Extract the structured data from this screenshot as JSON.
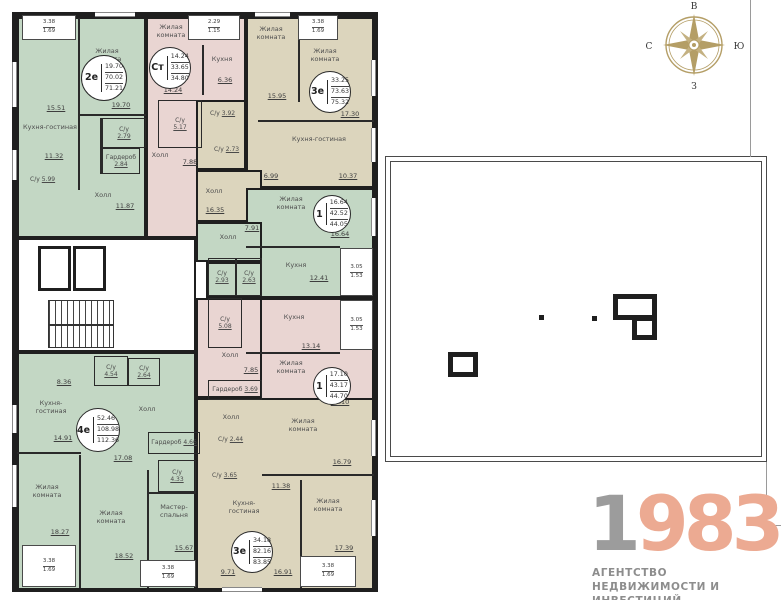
{
  "colors": {
    "green": "#c3d7c4",
    "pink": "#e9d5d2",
    "beige": "#dcd5bd",
    "wall": "#1f1f1f",
    "compass_gold": "#b49e66",
    "logo_gray": "#9c9c9c",
    "logo_accent": "#ecaa92",
    "logo_text": "#8d8d8d"
  },
  "compass": {
    "top": "В",
    "right": "Ю",
    "bottom": "З",
    "left": "С"
  },
  "logo": {
    "digit1": "1",
    "digits2": "983",
    "line1": "АГЕНТСТВО",
    "line2": "НЕДВИЖИМОСТИ И ИНВЕСТИЦИЙ"
  },
  "apartments": {
    "a2e": {
      "type": "2е",
      "stats": [
        "19.70",
        "70.02",
        "71.21"
      ],
      "rooms": {
        "living": {
          "name": "Жилая комната",
          "area": "19.70"
        },
        "kitchen": {
          "name": "Кухня-гостиная",
          "area1": "15.51",
          "area2": "11.32"
        },
        "su1": {
          "name": "С/у",
          "area": "2.79"
        },
        "wardrobe": {
          "name": "Гардероб",
          "area": "2.84"
        },
        "su2": {
          "name": "С/у",
          "area": "5.99"
        },
        "hall": {
          "name": "Холл",
          "area": "11.87"
        }
      },
      "balcony": {
        "a": "3.38",
        "b": "1.69"
      }
    },
    "ast": {
      "type": "Ст",
      "stats": [
        "14.24",
        "33.65",
        "34.80"
      ],
      "rooms": {
        "living": {
          "name": "Жилая комната",
          "area": "14.24"
        },
        "kitchen": {
          "name": "Кухня",
          "area": "6.36"
        },
        "su": {
          "name": "С/у",
          "area": "5.17"
        },
        "hall": {
          "name": "Холл",
          "area": "7.88"
        }
      },
      "balcony": {
        "a": "2.29",
        "b": "1.15"
      }
    },
    "a3e": {
      "type": "3е",
      "stats": [
        "33.25",
        "73.63",
        "75.32"
      ],
      "rooms": {
        "living1": {
          "name": "Жилая комната",
          "area": "15.95"
        },
        "living2": {
          "name": "Жилая комната",
          "area": "17.30"
        },
        "kitchen": {
          "name": "Кухня-гостиная",
          "area1": "6.99",
          "area2": "10.37"
        },
        "su1": {
          "name": "С/у",
          "area": "3.92"
        },
        "su2": {
          "name": "С/у",
          "area": "2.73"
        },
        "hall": {
          "name": "Холл",
          "area": "16.35"
        }
      },
      "balcony": {
        "a": "3.38",
        "b": "1.69"
      }
    },
    "a1g": {
      "type": "1",
      "stats": [
        "16.64",
        "42.52",
        "44.05"
      ],
      "rooms": {
        "living": {
          "name": "Жилая комната",
          "area": "16.64"
        },
        "kitchen": {
          "name": "Кухня",
          "area": "12.41"
        },
        "su1": {
          "name": "С/у",
          "area": "2.93"
        },
        "su2": {
          "name": "С/у",
          "area": "2.63"
        },
        "hall": {
          "name": "Холл",
          "area": "7.91"
        }
      },
      "balcony": {
        "a": "3.05",
        "b": "1.53"
      }
    },
    "a1p": {
      "type": "1",
      "stats": [
        "17.10",
        "43.17",
        "44.70"
      ],
      "rooms": {
        "living": {
          "name": "Жилая комната",
          "area": "17.10"
        },
        "kitchen": {
          "name": "Кухня",
          "area": "13.14"
        },
        "su": {
          "name": "С/у",
          "area": "5.08"
        },
        "hall": {
          "name": "Холл",
          "area": "7.85"
        },
        "wardrobe": {
          "name": "Гардероб",
          "area": "3.69"
        }
      },
      "balcony": {
        "a": "3.05",
        "b": "1.53"
      }
    },
    "a4e": {
      "type": "4е",
      "stats": [
        "52.46",
        "108.98",
        "112.36"
      ],
      "rooms": {
        "kitchen": {
          "name": "Кухня-гостиная",
          "area1": "8.36",
          "area2": "14.91"
        },
        "su1": {
          "name": "С/у",
          "area": "4.54"
        },
        "su2": {
          "name": "С/у",
          "area": "2.64"
        },
        "hall": {
          "name": "Холл",
          "area": "17.08"
        },
        "wardrobe": {
          "name": "Гардероб",
          "area": "4.66"
        },
        "su3": {
          "name": "С/у",
          "area": "4.33"
        },
        "living1": {
          "name": "Жилая комната",
          "area": "18.27"
        },
        "living2": {
          "name": "Жилая комната",
          "area": "18.52"
        },
        "master": {
          "name": "Мастер-спальня",
          "area": "15.67"
        }
      },
      "balcony1": {
        "a": "3.38",
        "b": "1.69"
      },
      "balcony2": {
        "a": "3.38",
        "b": "1.69"
      }
    },
    "a3eb": {
      "type": "3е",
      "stats": [
        "34.18",
        "82.16",
        "83.85"
      ],
      "rooms": {
        "hall": {
          "name": "Холл"
        },
        "su1": {
          "name": "С/у",
          "area": "2.44"
        },
        "living1": {
          "name": "Жилая комната",
          "area": "16.79"
        },
        "su2": {
          "name": "С/у",
          "area": "3.65"
        },
        "corridor": {
          "area": "11.38"
        },
        "kitchen": {
          "name": "Кухня-гостиная",
          "area1": "9.71",
          "area2": "16.91"
        },
        "living2": {
          "name": "Жилая комната",
          "area": "17.39"
        }
      },
      "balcony": {
        "a": "3.38",
        "b": "1.69"
      }
    }
  }
}
